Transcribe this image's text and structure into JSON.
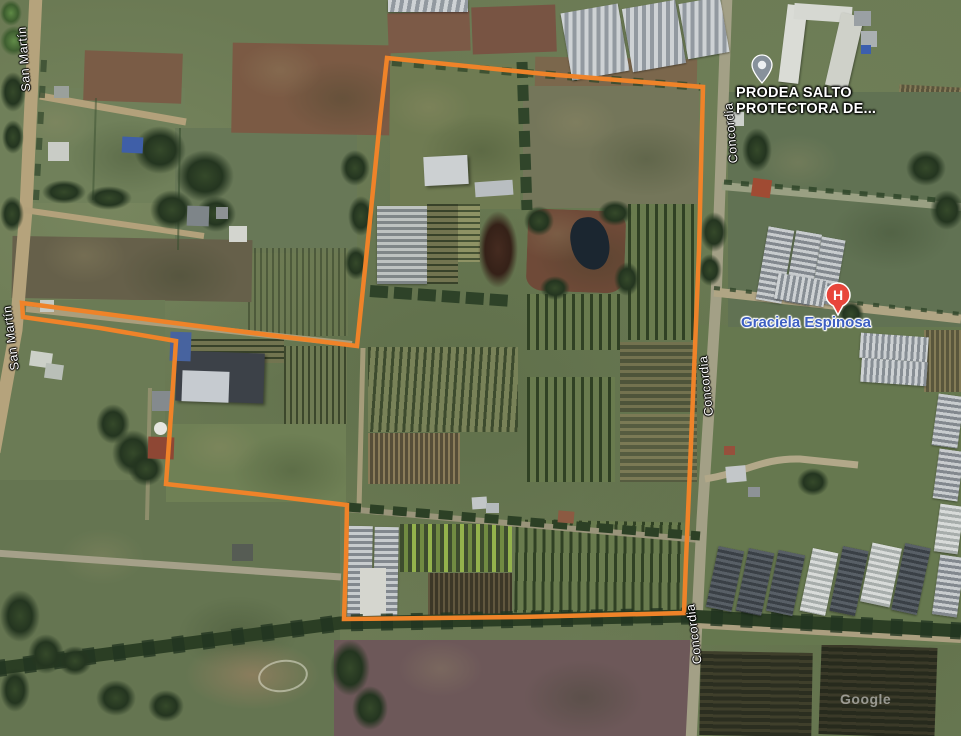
{
  "map": {
    "attribution": "Google",
    "boundary": {
      "color": "#ef8329",
      "points": "387,58 545,74 703,87 699,250 692,420 686,560 684,613 520,617 344,619 346,560 347,505 255,494 166,484 172,400 176,341 100,328 23,317 22,303 190,325 357,346 369,230 380,120"
    },
    "road_labels": [
      {
        "id": "san-martin-1",
        "text": "San Martín"
      },
      {
        "id": "san-martin-2",
        "text": "San Martín"
      },
      {
        "id": "concordia-1",
        "text": "Concordia"
      },
      {
        "id": "concordia-2",
        "text": "Concordia"
      },
      {
        "id": "concordia-3",
        "text": "Concordia"
      }
    ],
    "place_labels": [
      {
        "id": "prodea",
        "line1": "PRODEA SALTO",
        "line2": "PROTECTORA DE...",
        "color": "#ffffff"
      },
      {
        "id": "graciela",
        "text": "Graciela Espinosa",
        "color": "#3d5fc2"
      }
    ],
    "markers": [
      {
        "id": "prodea-pin",
        "type": "place",
        "color": "#87919b"
      },
      {
        "id": "hospital-pin",
        "type": "hospital",
        "letter": "H",
        "color": "#e8463b"
      }
    ]
  }
}
